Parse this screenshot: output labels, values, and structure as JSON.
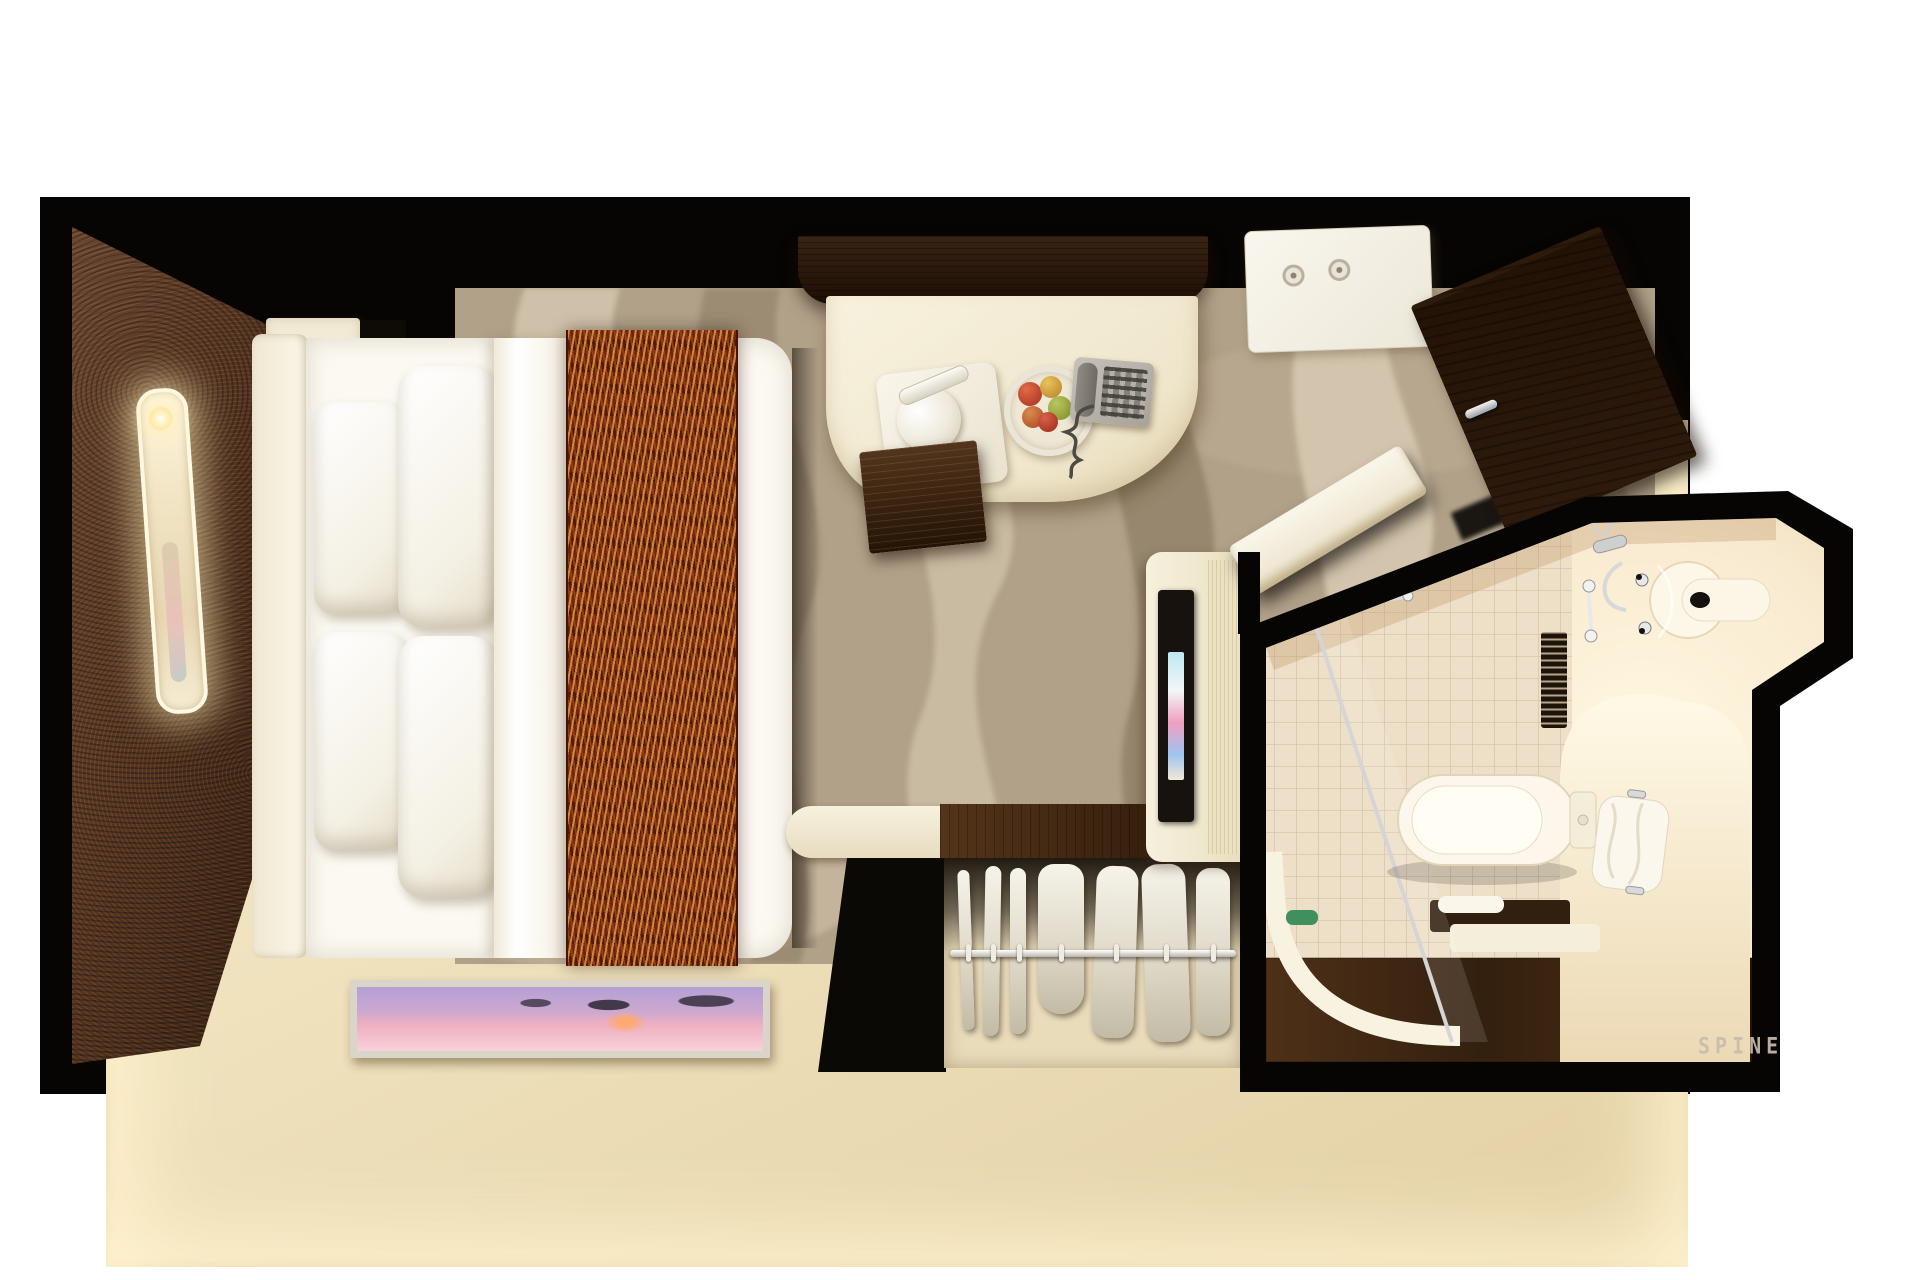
{
  "title": "Top-down 3D rendering of a cruise-ship studio stateroom floor plan",
  "watermark": {
    "text": "SPINE"
  },
  "palette": {
    "wall_outline": "#070503",
    "lit_wall_band": "#f4e9cb",
    "accent_wall_brown": "#53331f",
    "dark_wood": "#3a2413",
    "carpet_taupe": "#b1a189",
    "carpet_light": "#d3c5ad",
    "bedding_white": "#fbf9f1",
    "runner_rust": "#6e2514",
    "runner_gold": "#d8983e",
    "bathroom_glow": "#fff6dd",
    "tile_beige": "#eee0c8",
    "artwork_violet": "#b5a0d6",
    "artwork_pink": "#eeafc1"
  }
}
